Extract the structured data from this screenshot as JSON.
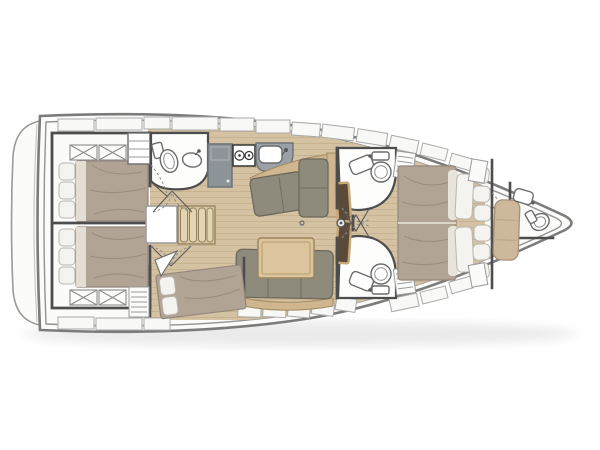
{
  "diagram": {
    "type": "boat-floor-plan",
    "subject": "sailing yacht interior layout plan, top-down view, bow pointing right",
    "areas": [
      {
        "name": "swim-platform",
        "position": "stern far left"
      },
      {
        "name": "aft-cabin-port",
        "contents": "double bed, pillows, two skylight hatches"
      },
      {
        "name": "aft-cabin-starboard",
        "contents": "double bed, pillows, two skylight hatches"
      },
      {
        "name": "aft-head",
        "contents": "toilet, washbasin"
      },
      {
        "name": "companionway",
        "contents": "stairs, storage box"
      },
      {
        "name": "galley",
        "contents": "fridge, two-burner stove, sink"
      },
      {
        "name": "salon",
        "contents": "L-sofa with chaise, straight sofa, dining table"
      },
      {
        "name": "mid-cabin-starboard",
        "contents": "double berth, pillows, louvered locker"
      },
      {
        "name": "forward-head-port",
        "contents": "washbasin, toilet, vanity bench"
      },
      {
        "name": "forward-head-starboard",
        "contents": "washbasin, toilet, vanity bench"
      },
      {
        "name": "owner-cabin",
        "contents": "island double bed, pillows, headboard cushions"
      },
      {
        "name": "bow-crew-compartment",
        "contents": "berth cushion, washbasin, toilet"
      }
    ],
    "icons": [
      "hatch-cross-icon",
      "stove-burner-icon",
      "faucet-icon",
      "toilet-icon",
      "sink-basin-icon",
      "martini-glass-icon",
      "mast-post-icon",
      "louver-vent-icon"
    ]
  },
  "palette": {
    "hull_stroke": "#7b7b7b",
    "hull_inner_stroke": "#939393",
    "deck_white": "#fbfbfa",
    "deck_panel": "#f8f8f6",
    "deck_panel_stroke": "#aaaaaa",
    "wall": "#4d4d4d",
    "wood_floor": "#d4c2a2",
    "wood_plank": "#c3ad8a",
    "duvet": "#b2a495",
    "duvet_fold": "#94867a",
    "sheet": "#e9e4da",
    "pillow": "#f4f3ef",
    "pillow_stroke": "#b9b6ad",
    "sofa": "#8e8a7c",
    "sofa_stroke": "#6c685c",
    "wood_trim": "#cfb68f",
    "table": "#dcc49c",
    "table_stroke": "#9b855d",
    "stairs": "#d9c7a4",
    "stairs_stroke": "#93805c",
    "counter": "#9ba1a6",
    "counter_stroke": "#6d7378",
    "fridge": "#8d9498",
    "fixture_stroke": "#6b6b6b",
    "room_white": "#fdfdfc",
    "vanity_dark": "#5c4a39",
    "vanity_border": "#c8a877",
    "bow_cushion": "#cdb89b",
    "shadow": "#000000"
  }
}
